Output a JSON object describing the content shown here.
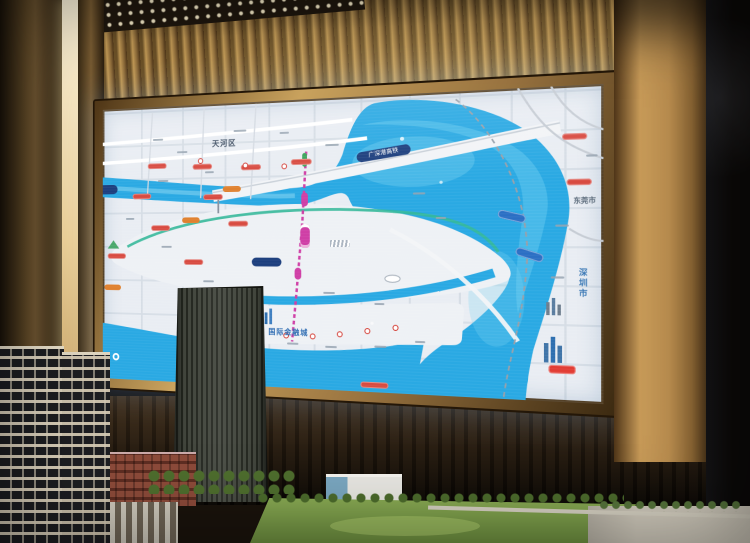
{
  "scene": {
    "screen_map": {
      "labels": {
        "district": "天河区",
        "financial_city": "国际金融城",
        "shenzhen": "深圳市",
        "dongguan": "东莞市",
        "rail_line": "广深港高铁"
      },
      "colors": {
        "river_blue": "#2aa9e3",
        "metro_magenta": "#cf3fa6",
        "route_red": "#d84b41",
        "route_orange": "#e0812f",
        "transit_blue": "#2b6fc4",
        "frame_gold": "#c9a35e"
      }
    },
    "environment_colors": {
      "wood_slats": "#a07c44",
      "dark_wall": "#241a10",
      "model_lawn": "#7da24b"
    }
  }
}
